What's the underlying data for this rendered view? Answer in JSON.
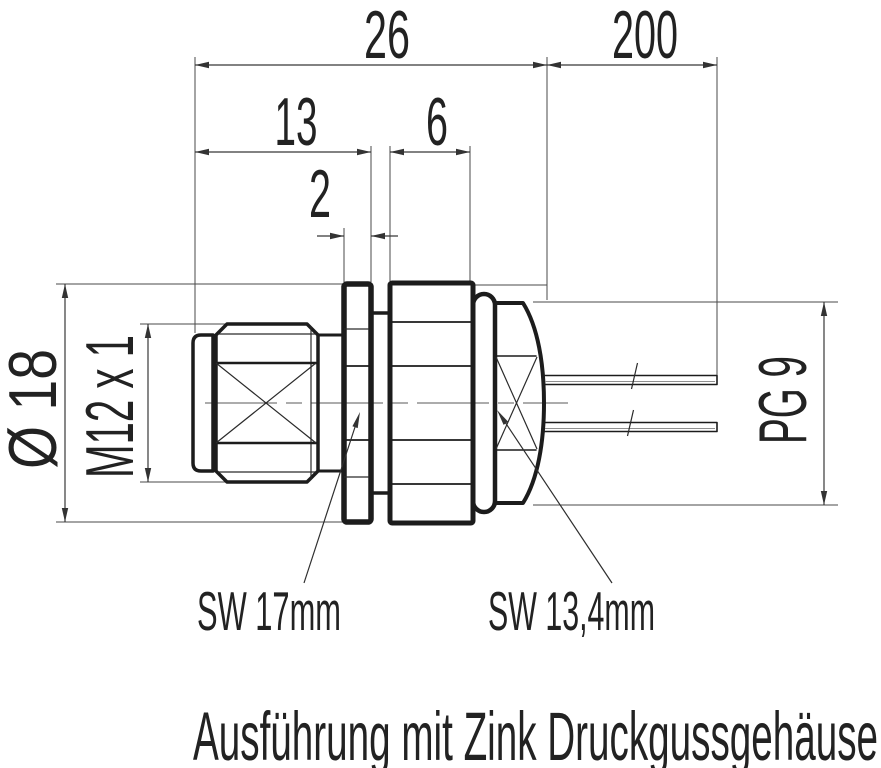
{
  "drawing": {
    "dim_26": "26",
    "dim_200": "200",
    "dim_13": "13",
    "dim_6": "6",
    "dim_2": "2",
    "dim_diameter": "Ø 18",
    "dim_thread": "M12 x 1",
    "dim_pg": "PG 9",
    "label_sw_flange": "SW 17mm",
    "label_sw_hex": "SW 13,4mm",
    "caption": "Ausführung mit Zink Druckgussgehäuse",
    "colors": {
      "line": "#1c1c1c",
      "dimension_line": "#3a3a3a",
      "text": "#222222",
      "background": "#ffffff"
    }
  }
}
